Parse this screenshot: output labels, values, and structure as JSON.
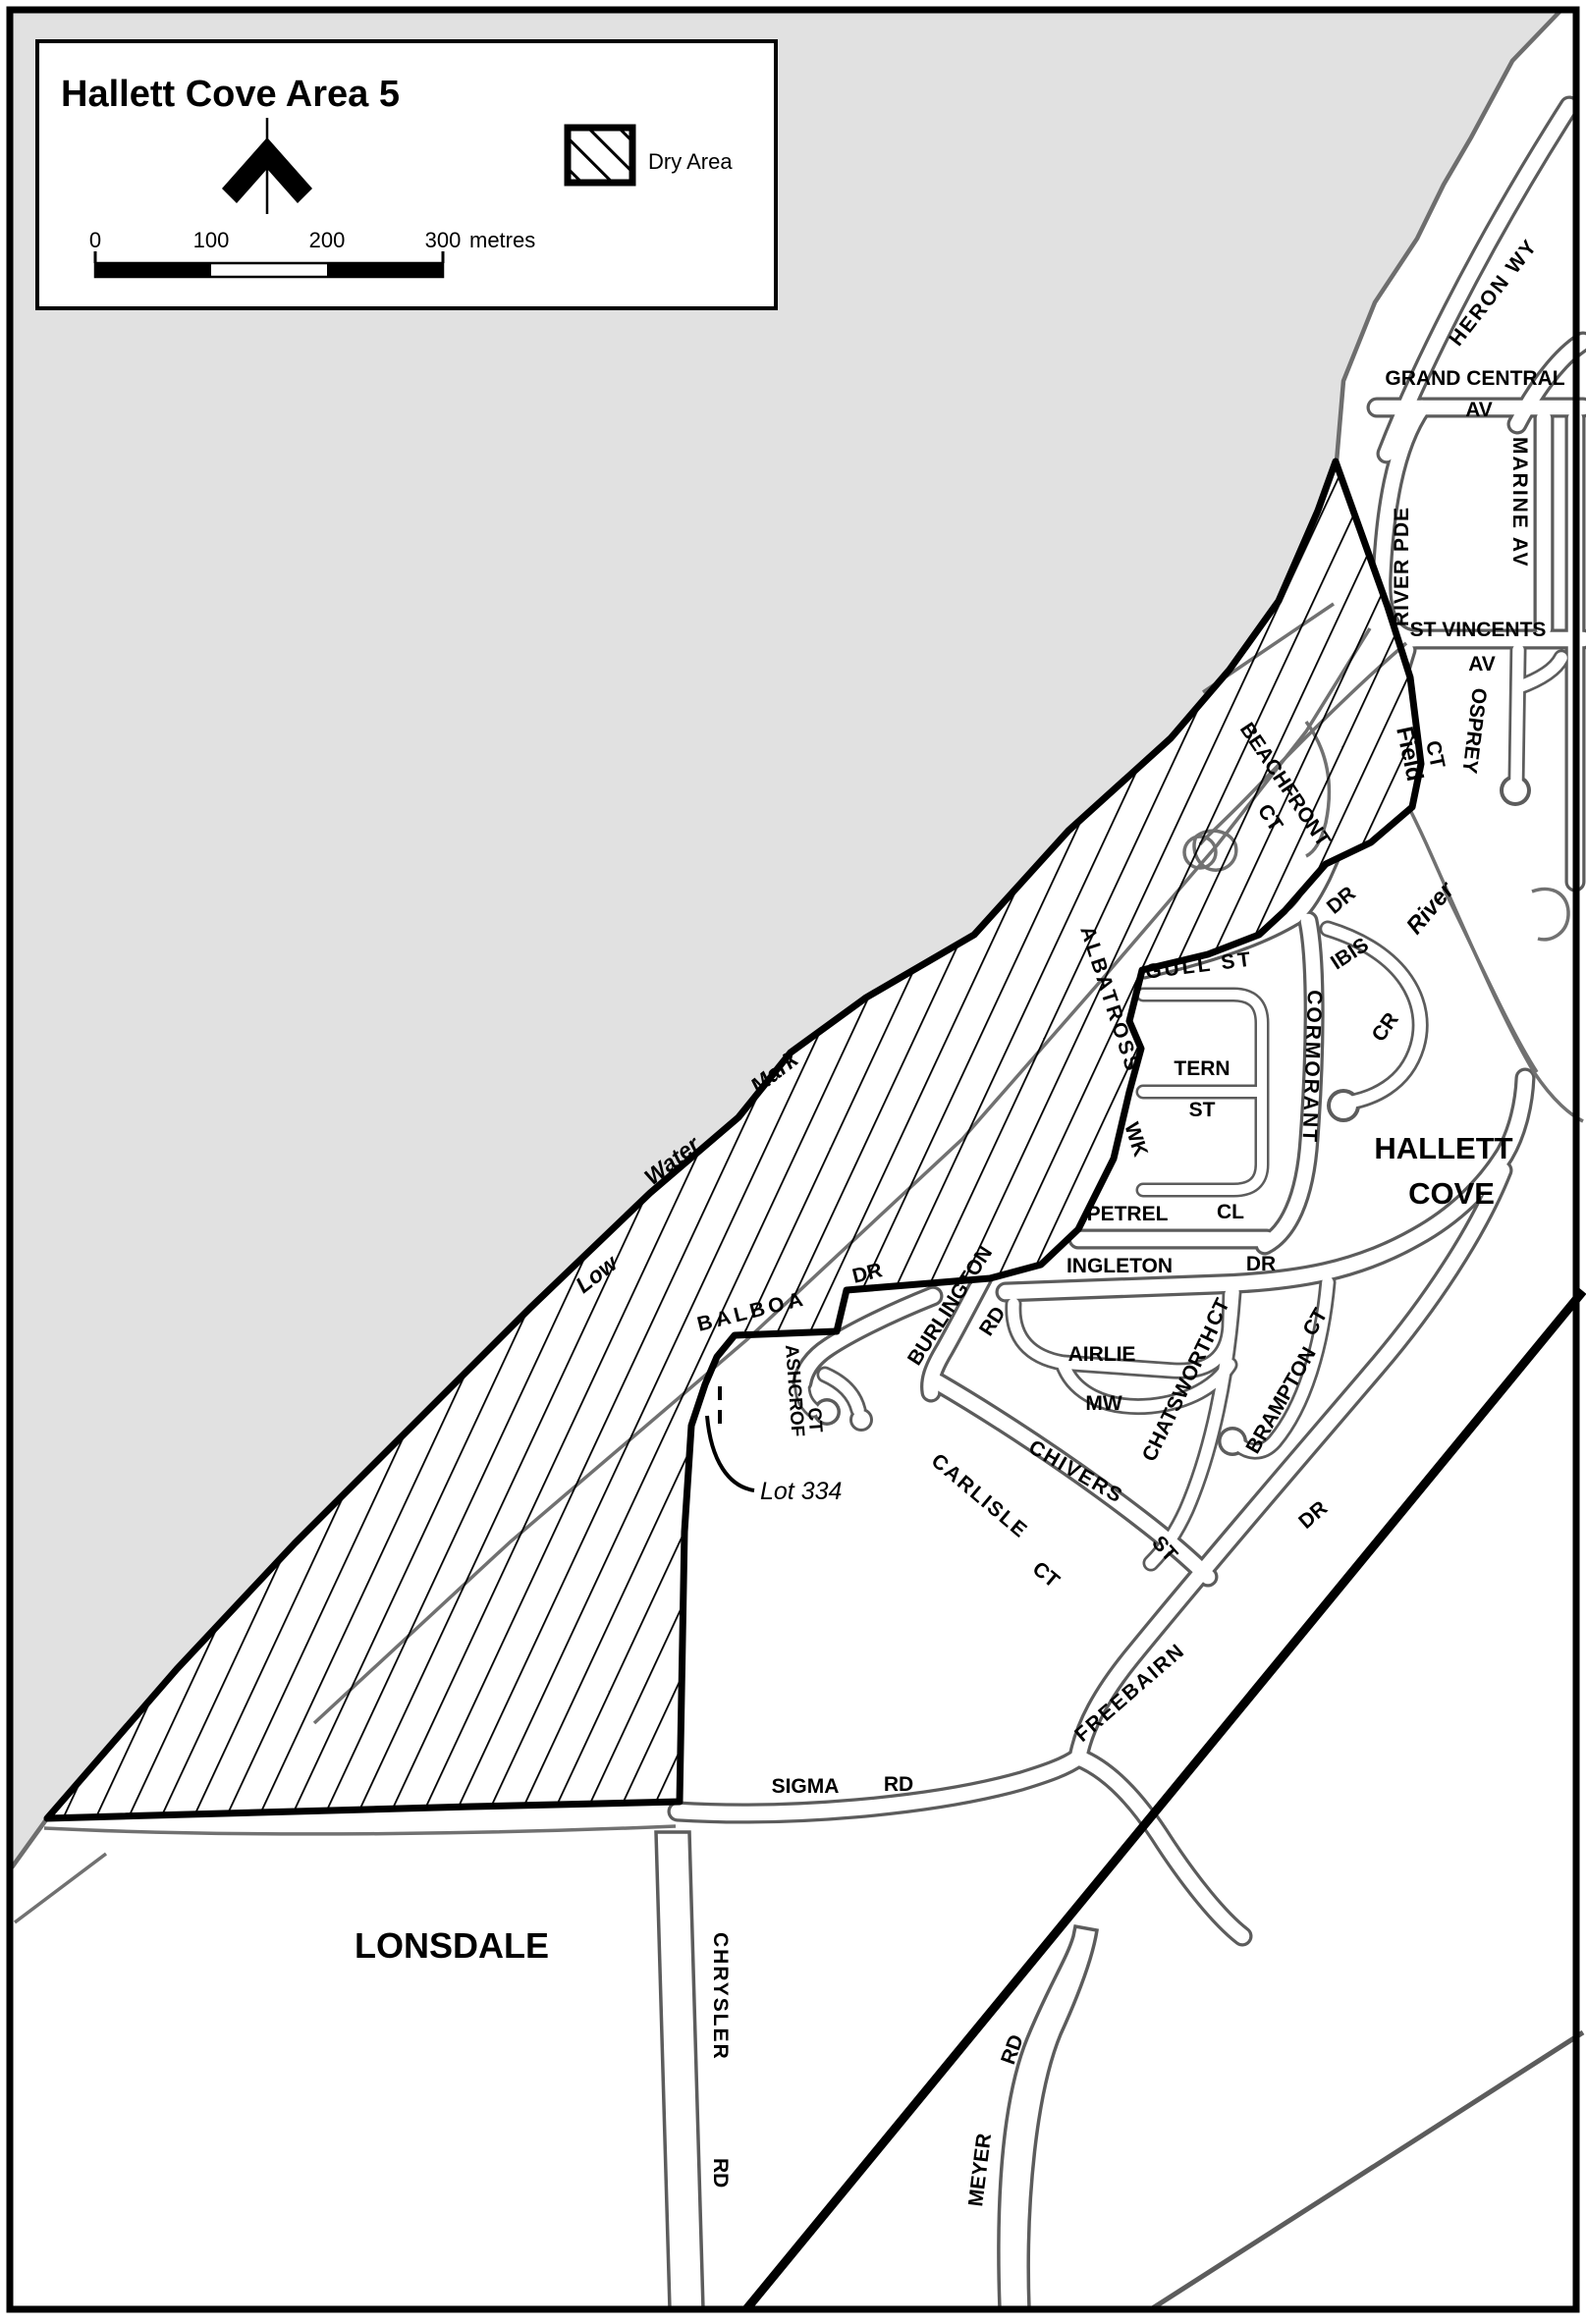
{
  "title_box": {
    "title": "Hallett Cove Area 5",
    "legend_label": "Dry Area",
    "scale": {
      "t0": "0",
      "t1": "100",
      "t2": "200",
      "t3": "300",
      "unit": "metres"
    }
  },
  "localities": {
    "hallett_line1": "HALLETT",
    "hallett_line2": "COVE",
    "lonsdale": "LONSDALE"
  },
  "streets": {
    "heron": "HERON WY",
    "grand_central": "GRAND CENTRAL",
    "grand_central_av": "AV",
    "marine": "MARINE  AV",
    "river_pde": "RIVER PDE",
    "st_vincents": "ST VINCENTS",
    "st_vincents_av": "AV",
    "osprey": "OSPREY",
    "field_ct": "CT",
    "beachfront": "BEACHFRONT",
    "beachfront_ct": "CT",
    "gull": "GULL  ST",
    "albatross": "ALBATROSS",
    "albatross_wk": "WK",
    "tern": "TERN",
    "tern_st": "ST",
    "cormorant": "CORMORANT",
    "cormorant_dr": "DR",
    "ibis": "IBIS",
    "ibis_cr": "CR",
    "petrel": "PETREL",
    "petrel_cl": "CL",
    "ingleton": "INGLETON",
    "ingleton_dr": "DR",
    "burlington": "BURLINGTON",
    "burlington_rd": "RD",
    "balboa": "BALBOA",
    "balboa_dr": "DR",
    "ashcrof": "ASHCROF",
    "ashcrof_ct": "CT",
    "airlie": "AIRLIE",
    "airlie_mw": "MW",
    "chatsworth": "CHATSWORTH",
    "chatsworth_ct": "CT",
    "brampton": "BRAMPTON",
    "brampton_ct": "CT",
    "chivers": "CHIVERS",
    "chivers_st": "ST",
    "carlisle": "CARLISLE",
    "carlisle_ct": "CT",
    "freebairn": "FREEBAIRN",
    "freebairn_dr": "DR",
    "sigma": "SIGMA",
    "sigma_rd": "RD",
    "chrysler": "CHRYSLER",
    "chrysler_rd": "RD",
    "meyer": "MEYER",
    "meyer_rd": "RD"
  },
  "water_labels": {
    "low": "Low",
    "water": "Water",
    "mark": "Mark",
    "field": "Field",
    "river": "River"
  },
  "annotations": {
    "lot": "Lot 334"
  },
  "colors": {
    "water": "#e1e1e1",
    "road_casing": "#5c5c5c",
    "boundary": "#000000"
  }
}
